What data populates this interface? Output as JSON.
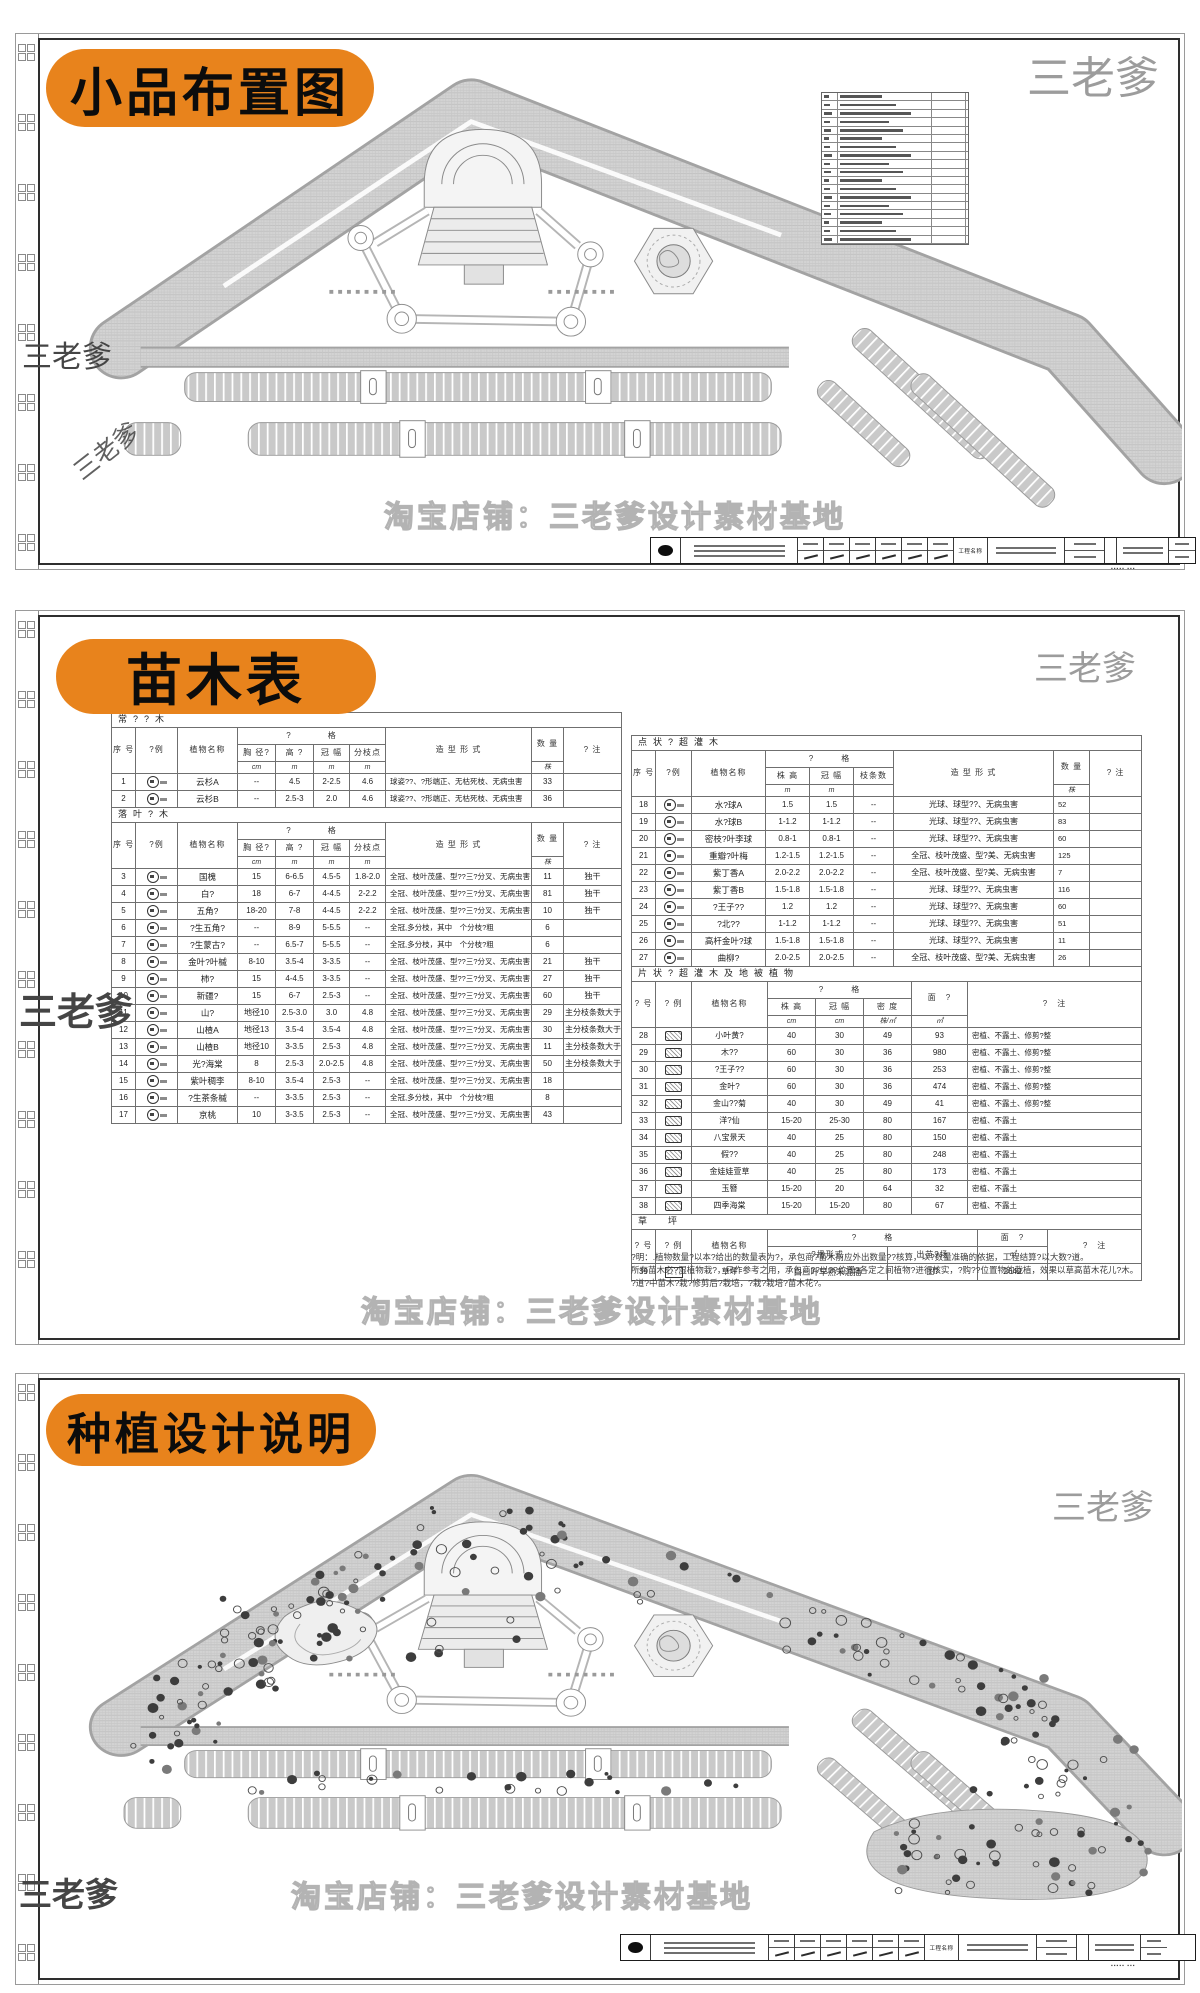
{
  "watermark": {
    "brand": "三老爹",
    "shop_line": "淘宝店铺：三老爹设计素材基地"
  },
  "panel1": {
    "label": "小品布置图",
    "legend_rows": 18
  },
  "panel2": {
    "label": "苗木表"
  },
  "panel3": {
    "label": "种植设计说明"
  },
  "titleblock": {
    "project_label": "工程名称"
  },
  "notes": [
    "?明：.植物数量?以本?给出的数量表为?，承包商?苗木前应外出数量??核算，以?数量准确的依据，工程结算?以大数?道。",
    "所有苗木必?湿植物栽?，只作参考之用，承包商??以??位置?各定之间植物?进行核实，?购??位置物的栽植，效果以草高苗木花儿?木。",
    "?道?中苗木?栽?修剪后?栽培，?栽?栽培?苗木花?。"
  ],
  "tables": {
    "left": {
      "sections": [
        {
          "kind": "tree",
          "title": "常??木",
          "hrows": [
            [
              {
                "t": "序 号",
                "rs": 3
              },
              {
                "t": "?例",
                "rs": 3
              },
              {
                "t": "植物名称",
                "rs": 3
              },
              {
                "t": "?　　　　格",
                "cs": 4
              },
              {
                "t": "造 型 形 式",
                "rs": 3
              },
              {
                "t": "数 量",
                "rs": 2
              },
              {
                "t": "? 注",
                "rs": 3
              }
            ],
            [
              {
                "t": "胸 径?"
              },
              {
                "t": "高 ?"
              },
              {
                "t": "冠 幅"
              },
              {
                "t": "分枝点"
              }
            ],
            [
              {
                "t": "cm",
                "u": 1
              },
              {
                "t": "m",
                "u": 1
              },
              {
                "t": "m",
                "u": 1
              },
              {
                "t": "m",
                "u": 1
              },
              {
                "t": "株",
                "u": 1
              }
            ]
          ],
          "rows": [
            [
              "1",
              "@c",
              "云杉A",
              "--",
              "4.5",
              "2-2.5",
              "4.6",
              "球姿??、?形端正、无枯死枝、无病虫害",
              "33",
              ""
            ],
            [
              "2",
              "@c",
              "云杉B",
              "--",
              "2.5-3",
              "2.0",
              "4.6",
              "球姿??、?形端正、无枯死枝、无病虫害",
              "36",
              ""
            ]
          ]
        },
        {
          "kind": "tree",
          "title": "落叶?木",
          "hrows": [
            [
              {
                "t": "序 号",
                "rs": 3
              },
              {
                "t": "?例",
                "rs": 3
              },
              {
                "t": "植物名称",
                "rs": 3
              },
              {
                "t": "?　　　　格",
                "cs": 4
              },
              {
                "t": "造 型 形 式",
                "rs": 3
              },
              {
                "t": "数 量",
                "rs": 2
              },
              {
                "t": "? 注",
                "rs": 3
              }
            ],
            [
              {
                "t": "胸 径?"
              },
              {
                "t": "高 ?"
              },
              {
                "t": "冠 幅"
              },
              {
                "t": "分枝点"
              }
            ],
            [
              {
                "t": "cm",
                "u": 1
              },
              {
                "t": "m",
                "u": 1
              },
              {
                "t": "m",
                "u": 1
              },
              {
                "t": "m",
                "u": 1
              },
              {
                "t": "株",
                "u": 1
              }
            ]
          ],
          "rows": [
            [
              "3",
              "@c",
              "国槐",
              "15",
              "6-6.5",
              "4.5-5",
              "1.8-2.0",
              "全冠、枝叶茂盛、型??三?分叉、无病虫害",
              "11",
              "独干"
            ],
            [
              "4",
              "@c",
              "白?",
              "18",
              "6-7",
              "4-4.5",
              "2-2.2",
              "全冠、枝叶茂盛、型??三?分叉、无病虫害",
              "81",
              "独干"
            ],
            [
              "5",
              "@c",
              "五角?",
              "18-20",
              "7-8",
              "4-4.5",
              "2-2.2",
              "全冠、枝叶茂盛、型??三?分叉、无病虫害",
              "10",
              "独干"
            ],
            [
              "6",
              "@c",
              "?生五角?",
              "--",
              "8-9",
              "5-5.5",
              "--",
              "全冠,多分枝，其中　个分枝?粗",
              "6",
              ""
            ],
            [
              "7",
              "@c",
              "?生蒙古?",
              "--",
              "6.5-7",
              "5-5.5",
              "--",
              "全冠,多分枝，其中　个分枝?粗",
              "6",
              ""
            ],
            [
              "8",
              "@c",
              "金叶?叶槭",
              "8-10",
              "3.5-4",
              "3-3.5",
              "--",
              "全冠、枝叶茂盛、型??三?分叉、无病虫害",
              "21",
              "独干"
            ],
            [
              "9",
              "@c",
              "柿?",
              "15",
              "4-4.5",
              "3-3.5",
              "--",
              "全冠、枝叶茂盛、型??三?分叉、无病虫害",
              "27",
              "独干"
            ],
            [
              "10",
              "@c",
              "新疆?",
              "15",
              "6-7",
              "2.5-3",
              "--",
              "全冠、枝叶茂盛、型??三?分叉、无病虫害",
              "60",
              "独干"
            ],
            [
              "11",
              "@c",
              "山?",
              "地径10",
              "2.5-3.0",
              "3.0",
              "4.8",
              "全冠、枝叶茂盛、型??三?分叉、无病虫害",
              "29",
              "主分枝条数大于3"
            ],
            [
              "12",
              "@c",
              "山楂A",
              "地径13",
              "3.5-4",
              "3.5-4",
              "4.8",
              "全冠、枝叶茂盛、型??三?分叉、无病虫害",
              "30",
              "主分枝条数大于3"
            ],
            [
              "13",
              "@c",
              "山楂B",
              "地径10",
              "3-3.5",
              "2.5-3",
              "4.8",
              "全冠、枝叶茂盛、型??三?分叉、无病虫害",
              "11",
              "主分枝条数大于3"
            ],
            [
              "14",
              "@c",
              "光?海棠",
              "8",
              "2.5-3",
              "2.0-2.5",
              "4.8",
              "全冠、枝叶茂盛、型??三?分叉、无病虫害",
              "50",
              "主分枝条数大于3"
            ],
            [
              "15",
              "@c",
              "紫叶稠李",
              "8-10",
              "3.5-4",
              "2.5-3",
              "--",
              "全冠、枝叶茂盛、型??三?分叉、无病虫害",
              "18",
              ""
            ],
            [
              "16",
              "@c",
              "?生茶条槭",
              "--",
              "3-3.5",
              "2.5-3",
              "--",
              "全冠,多分枝，其中　个分枝?粗",
              "8",
              ""
            ],
            [
              "17",
              "@c",
              "京桃",
              "10",
              "3-3.5",
              "2.5-3",
              "--",
              "全冠、枝叶茂盛、型??三?分叉、无病虫害",
              "43",
              ""
            ]
          ]
        }
      ]
    },
    "right": {
      "sections": [
        {
          "kind": "point",
          "title": "点状?超灌木",
          "hrows": [
            [
              {
                "t": "序 号",
                "rs": 3
              },
              {
                "t": "?例",
                "rs": 3
              },
              {
                "t": "植物名称",
                "rs": 3
              },
              {
                "t": "?　　　格",
                "cs": 3
              },
              {
                "t": "造 型 形 式",
                "rs": 3
              },
              {
                "t": "数 量",
                "rs": 2
              },
              {
                "t": "? 注",
                "rs": 3
              }
            ],
            [
              {
                "t": "株 高"
              },
              {
                "t": "冠 幅"
              },
              {
                "t": "枝条数"
              }
            ],
            [
              {
                "t": "m",
                "u": 1
              },
              {
                "t": "m",
                "u": 1
              },
              {
                "t": "",
                "u": 1
              },
              {
                "t": "株",
                "u": 1
              }
            ]
          ],
          "rows": [
            [
              "18",
              "@c",
              "水?球A",
              "1.5",
              "1.5",
              "--",
              "光球、球型??、无病虫害",
              "52",
              ""
            ],
            [
              "19",
              "@c",
              "水?球B",
              "1-1.2",
              "1-1.2",
              "--",
              "光球、球型??、无病虫害",
              "83",
              ""
            ],
            [
              "20",
              "@c",
              "密枝?叶李球",
              "0.8-1",
              "0.8-1",
              "--",
              "光球、球型??、无病虫害",
              "60",
              ""
            ],
            [
              "21",
              "@c",
              "重瓣?叶梅",
              "1.2-1.5",
              "1.2-1.5",
              "--",
              "全冠、枝叶茂盛、型?美、无病虫害",
              "125",
              ""
            ],
            [
              "22",
              "@c",
              "紫丁香A",
              "2.0-2.2",
              "2.0-2.2",
              "--",
              "全冠、枝叶茂盛、型?美、无病虫害",
              "7",
              ""
            ],
            [
              "23",
              "@c",
              "紫丁香B",
              "1.5-1.8",
              "1.5-1.8",
              "--",
              "光球、球型??、无病虫害",
              "116",
              ""
            ],
            [
              "24",
              "@c",
              "?王子??",
              "1.2",
              "1.2",
              "--",
              "光球、球型??、无病虫害",
              "60",
              ""
            ],
            [
              "25",
              "@c",
              "?北??",
              "1-1.2",
              "1-1.2",
              "--",
              "光球、球型??、无病虫害",
              "51",
              ""
            ],
            [
              "26",
              "@c",
              "高杆金叶?球",
              "1.5-1.8",
              "1.5-1.8",
              "--",
              "光球、球型??、无病虫害",
              "11",
              ""
            ],
            [
              "27",
              "@c",
              "曲柳?",
              "2.0-2.5",
              "2.0-2.5",
              "--",
              "全冠、枝叶茂盛、型?美、无病虫害",
              "26",
              ""
            ]
          ]
        },
        {
          "kind": "area",
          "title": "片状?超灌木及地被植物",
          "hrows": [
            [
              {
                "t": "? 号",
                "rs": 3
              },
              {
                "t": "? 例",
                "rs": 3
              },
              {
                "t": "植物名称",
                "rs": 3
              },
              {
                "t": "?　　　格",
                "cs": 3
              },
              {
                "t": "面　?",
                "rs": 2
              },
              {
                "t": "?　注",
                "rs": 3
              }
            ],
            [
              {
                "t": "株 高"
              },
              {
                "t": "冠 幅"
              },
              {
                "t": "密 度"
              }
            ],
            [
              {
                "t": "cm",
                "u": 1
              },
              {
                "t": "cm",
                "u": 1
              },
              {
                "t": "株/㎡",
                "u": 1
              },
              {
                "t": "㎡",
                "u": 1
              }
            ]
          ],
          "rows": [
            [
              "28",
              "@p",
              "小叶黄?",
              "40",
              "30",
              "49",
              "93",
              "密植、不露土、修剪?整"
            ],
            [
              "29",
              "@p",
              "木??",
              "60",
              "30",
              "36",
              "980",
              "密植、不露土、修剪?整"
            ],
            [
              "30",
              "@p",
              "?王子??",
              "60",
              "30",
              "36",
              "253",
              "密植、不露土、修剪?整"
            ],
            [
              "31",
              "@p",
              "金叶?",
              "60",
              "30",
              "36",
              "474",
              "密植、不露土、修剪?整"
            ],
            [
              "32",
              "@p",
              "金山??菊",
              "40",
              "30",
              "49",
              "41",
              "密植、不露土、修剪?整"
            ],
            [
              "33",
              "@p",
              "洋?仙",
              "15-20",
              "25-30",
              "80",
              "167",
              "密植、不露土"
            ],
            [
              "34",
              "@p",
              "八宝景天",
              "40",
              "25",
              "80",
              "150",
              "密植、不露土"
            ],
            [
              "35",
              "@p",
              "假??",
              "40",
              "25",
              "80",
              "248",
              "密植、不露土"
            ],
            [
              "36",
              "@p",
              "金娃娃萱草",
              "40",
              "25",
              "80",
              "173",
              "密植、不露土"
            ],
            [
              "37",
              "@p",
              "玉簪",
              "15-20",
              "20",
              "64",
              "32",
              "密植、不露土"
            ],
            [
              "38",
              "@p",
              "四季海棠",
              "15-20",
              "15-20",
              "80",
              "67",
              "密植、不露土"
            ]
          ]
        },
        {
          "kind": "lawn",
          "title": "草　坪",
          "hrows": [
            [
              {
                "t": "? 号",
                "rs": 2
              },
              {
                "t": "? 例",
                "rs": 2
              },
              {
                "t": "植物名称",
                "rs": 2
              },
              {
                "t": "?　　　格",
                "cs": 2
              },
              {
                "t": "面　?",
                "rs": 1
              },
              {
                "t": "?　注",
                "rs": 2
              }
            ],
            [
              {
                "t": "?播形式"
              },
              {
                "t": "出苗?场"
              },
              {
                "t": "㎡",
                "u": 1
              }
            ]
          ],
          "rows": [
            [
              "39",
              "@h",
              "草坪",
              "白三叶早熟禾混播",
              "图?",
              "2642",
              ""
            ]
          ]
        }
      ]
    }
  }
}
